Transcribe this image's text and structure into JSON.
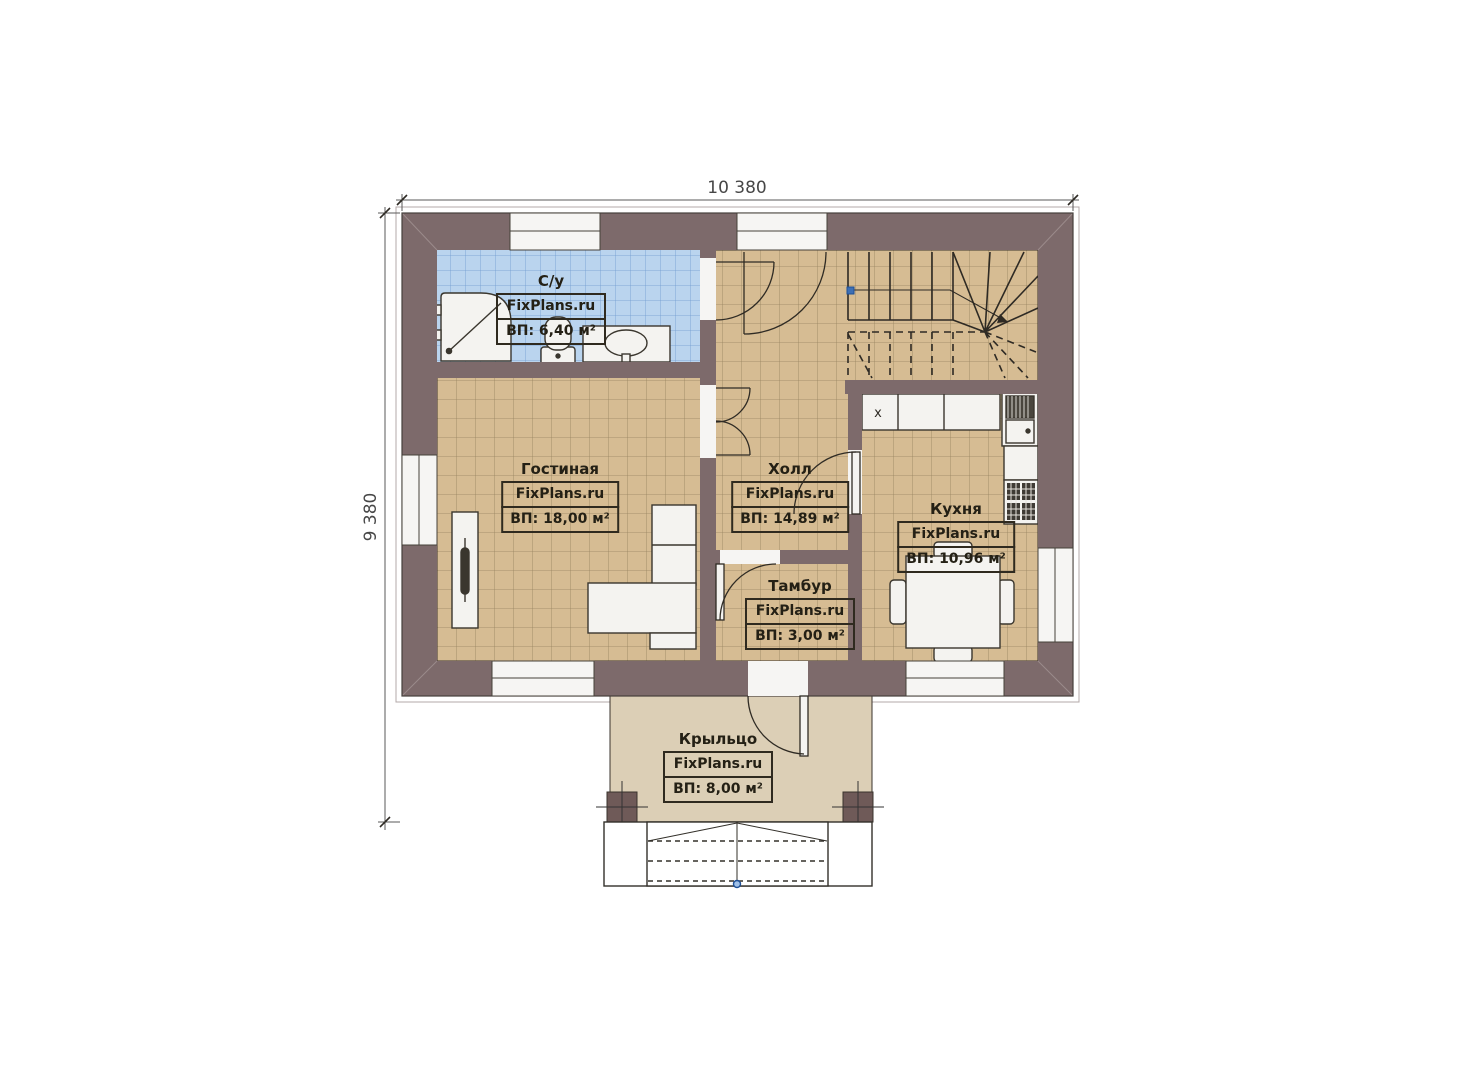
{
  "plan": {
    "type": "floor-plan",
    "watermark": "FixPlans.ru",
    "dimensions": {
      "top": "10 380",
      "left": "9 380"
    },
    "rooms": [
      {
        "id": "bathroom",
        "name": "С/у",
        "brand": "FixPlans.ru",
        "area": "ВП: 6,40 м²"
      },
      {
        "id": "living",
        "name": "Гостиная",
        "brand": "FixPlans.ru",
        "area": "ВП: 18,00 м²"
      },
      {
        "id": "hall",
        "name": "Холл",
        "brand": "FixPlans.ru",
        "area": "ВП: 14,89 м²"
      },
      {
        "id": "kitchen",
        "name": "Кухня",
        "brand": "FixPlans.ru",
        "area": "ВП: 10,96 м²"
      },
      {
        "id": "tambour",
        "name": "Тамбур",
        "brand": "FixPlans.ru",
        "area": "ВП: 3,00 м²"
      },
      {
        "id": "porch",
        "name": "Крыльцо",
        "brand": "FixPlans.ru",
        "area": "ВП: 8,00 м²"
      }
    ],
    "marks": {
      "cabinet": "x"
    },
    "colors": {
      "wall": "#7d6a6b",
      "column": "#6f5a58",
      "floor": "#d6bc93",
      "floor_grid": "#97835f",
      "bath_tile": "#bad4ee",
      "bath_grid": "#6f9bd0",
      "porch": "#dccfb6",
      "fixture": "#f4f3f0",
      "line": "#2e2a24",
      "accent_blue": "#3d6fb4"
    }
  }
}
